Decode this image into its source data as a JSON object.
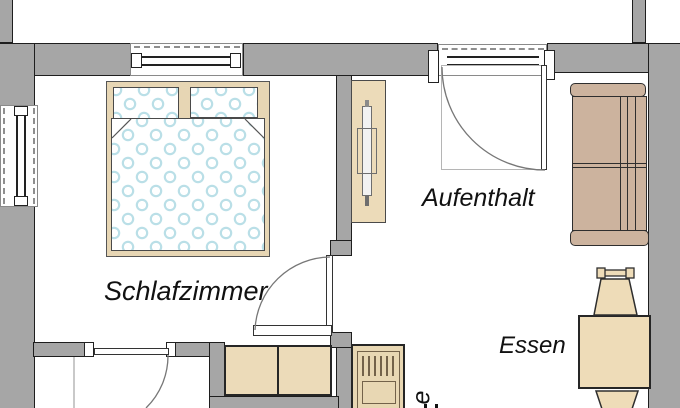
{
  "plan": {
    "type": "apartment floor plan",
    "language": "German"
  },
  "rooms": {
    "bedroom": {
      "label": "Schlafzimmer"
    },
    "lounge": {
      "label": "Aufenthalt"
    },
    "dining": {
      "label": "Essen"
    },
    "partial_room": {
      "label": "e"
    }
  },
  "furniture": {
    "bed": "double bed with two pillows and polka-dot duvet",
    "sideboard": "sideboard with TV",
    "sofa": "two-seat sofa against right wall",
    "dining_table": "dining table with two chairs",
    "cabinet": "low cabinet / counter",
    "kitchen_unit": "kitchen appliance (sink/stove unit)"
  },
  "openings": {
    "windows": "3 (left wall, above bed, beside entrance)",
    "doors": "3 (entrance door, bedroom door, hall door)"
  },
  "colors": {
    "wall_gray": "#a6a6a6",
    "outline_dark": "#1e1e1e",
    "furniture_tan": "#ecdbb9",
    "bed_frame_tan": "#e7d6b4",
    "sofa_taupe": "#ccb39e",
    "polka_dot_blue": "#badfe7",
    "background": "#ffffff",
    "text": "#111111"
  }
}
